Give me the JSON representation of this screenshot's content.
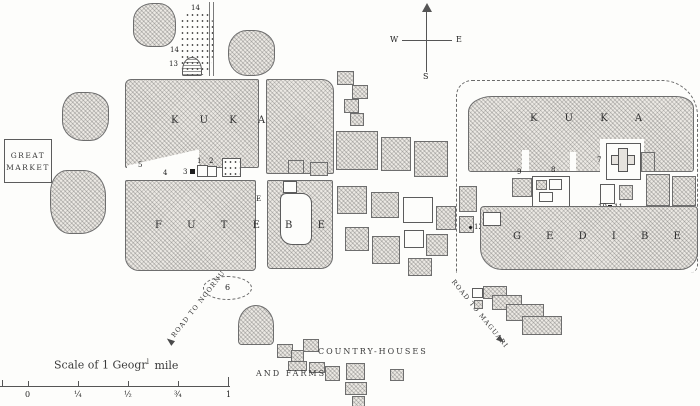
{
  "map": {
    "compass": {
      "west": "W",
      "east": "E",
      "south": "S"
    },
    "great_market": {
      "line1": "GREAT",
      "line2": "MARKET"
    },
    "west_town": {
      "name": "K U K A",
      "district": "F U T E B E"
    },
    "east_town": {
      "name": "K U K A",
      "district": "G E D I B E"
    },
    "annotations": {
      "country_houses": "COUNTRY-HOUSES",
      "and_farms": "AND FARMS"
    },
    "roads": {
      "southwest": "ROAD TO NGORNU",
      "southeast": "ROAD TO MAGUARI"
    },
    "markers": {
      "m1": "1",
      "m2": "2",
      "m3": "3",
      "m4": "4",
      "m5": "5",
      "m6": "6",
      "m7": "7",
      "m8": "8",
      "m9": "9",
      "m10": "10",
      "m11": "11",
      "m12": "12",
      "m13": "13",
      "m14a": "14",
      "m14b": "14",
      "mE": "E"
    },
    "scale": {
      "title_prefix": "Scale of 1 Geogr",
      "title_sup": "l",
      "title_suffix": "mile",
      "ticks": [
        "0",
        "¼",
        "½",
        "¾",
        "1"
      ]
    }
  }
}
